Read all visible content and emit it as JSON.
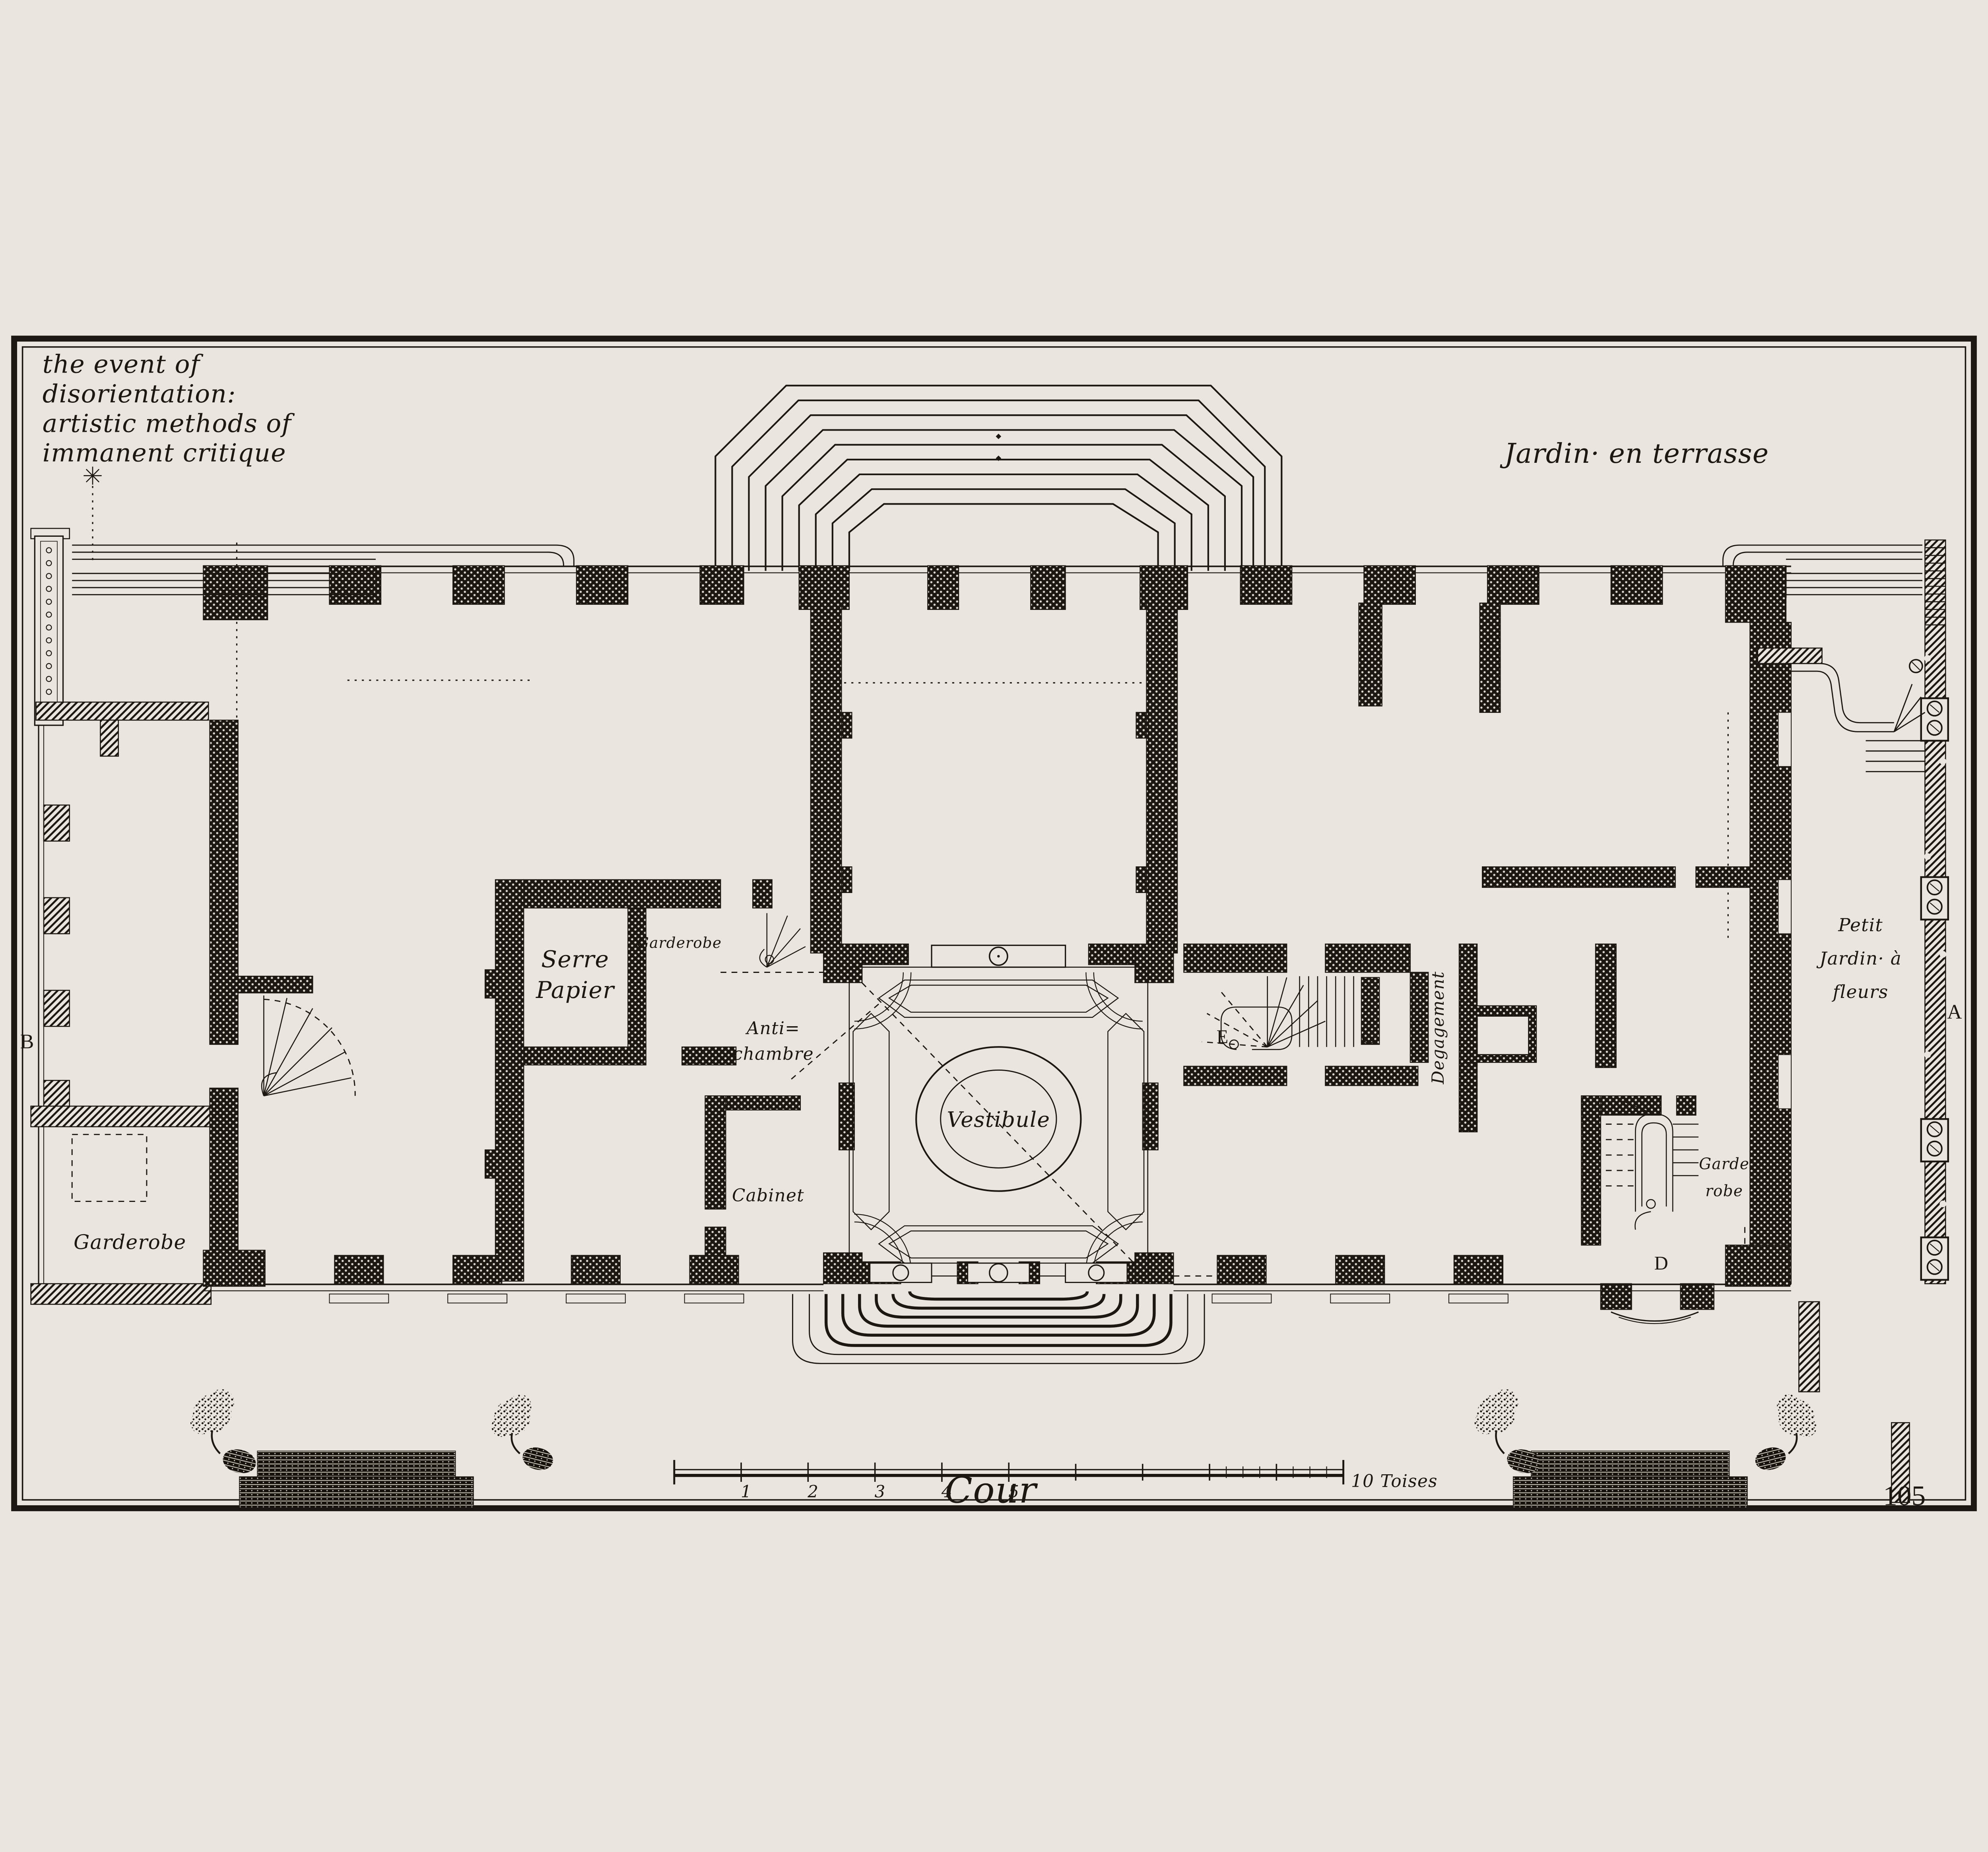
{
  "plate": {
    "title_lines": [
      "the event of",
      "disorientation:",
      "artistic methods of",
      "immanent critique"
    ],
    "page_number": "105"
  },
  "garden": {
    "label": "Jardin·  en terrasse"
  },
  "court": {
    "label": "Cour"
  },
  "rooms": {
    "vestibule": "Vestibule",
    "serre_papier": [
      "Serre",
      "Papier"
    ],
    "garderobe_small": "Garderobe",
    "antichambre": [
      "Anti=",
      "chambre"
    ],
    "cabinet": "Cabinet",
    "garderobe_left": "Garderobe",
    "degagement": "Degagement",
    "garde_robe_right": [
      "Garde",
      "robe"
    ],
    "petit_jardin": [
      "Petit",
      "Jardin· à",
      "fleurs"
    ]
  },
  "keys": {
    "A": "A",
    "B": "B",
    "C": "C",
    "D": "D",
    "E": "E"
  },
  "scale_bar": {
    "tick_labels": [
      "1",
      "2",
      "3",
      "4",
      "5"
    ],
    "end_label": "10 Toises"
  },
  "colors": {
    "paper": "#e9e6df",
    "ink": "#1b1713"
  }
}
